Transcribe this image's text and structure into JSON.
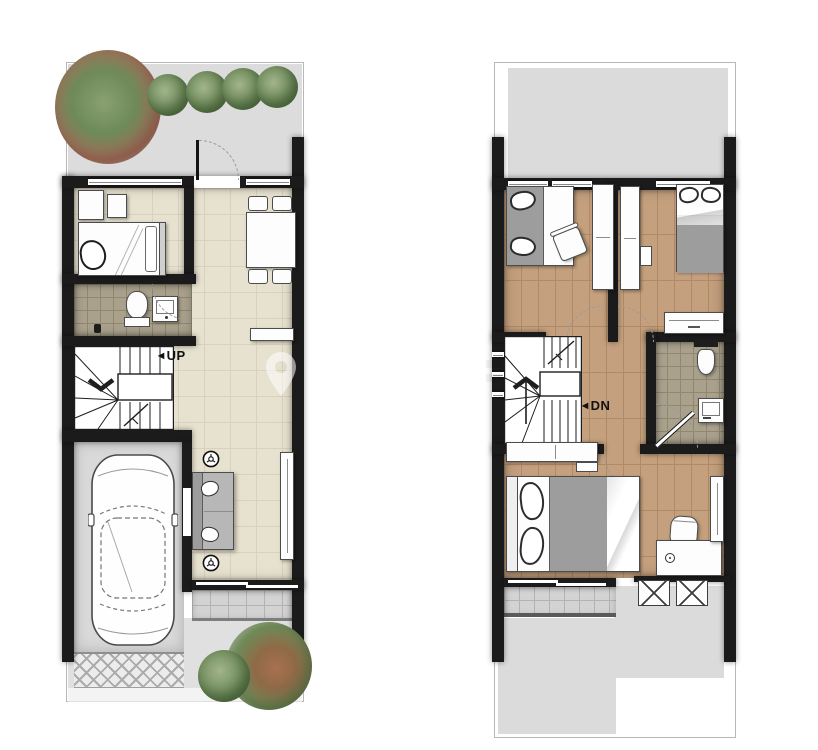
{
  "document": {
    "type": "floor-plan-pair",
    "left_plan": "first-floor",
    "right_plan": "second-floor"
  },
  "labels": {
    "up": "UP",
    "dn": "DN"
  },
  "watermark": {
    "icon": "location-pin-icon"
  },
  "palette": {
    "wall": "#1b1b1b",
    "garden": "#dcdcdd",
    "roof": "#dbdbdc",
    "floor_tile": "#e7e1cf",
    "floor_tile_line": "#d7d1bd",
    "bath_tile": "#a9a18c",
    "bath_tile_line": "#8f876e",
    "wood": "#c4a07e",
    "wood_line": "#b08a66",
    "garage": "#d9d9d9",
    "terrace": "#d3d3d3",
    "terrace_line": "#b3b3b3",
    "furniture": "#fdfdfd",
    "furniture_border": "#4c4c4c",
    "sofa": "#b7b7b7",
    "blanket": "#9d9d9d",
    "label": "#111111"
  },
  "icons": {
    "trees": "tree-icon",
    "car": "car-icon",
    "ceiling_light": "ceiling-light-icon",
    "ac_unit": "ac-unit-icon",
    "watermark_pin": "location-pin-icon"
  }
}
